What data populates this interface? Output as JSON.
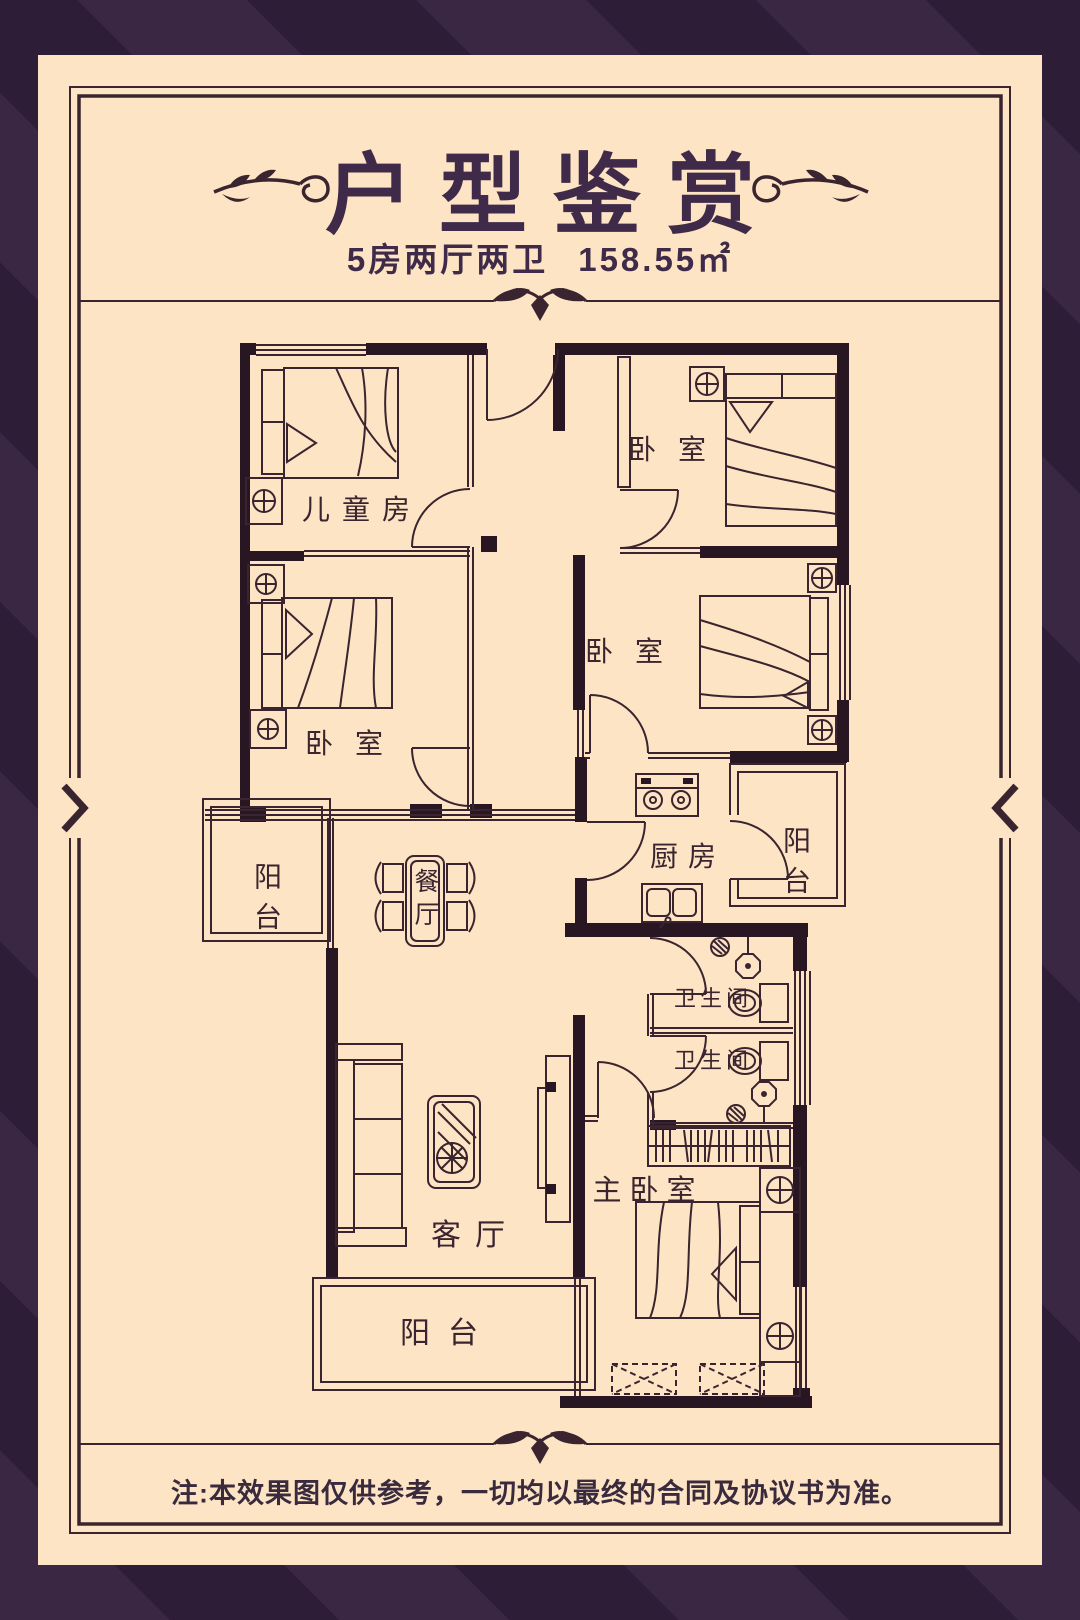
{
  "header": {
    "title": "户型鉴赏",
    "subtitle_layout": "5房两厅两卫",
    "subtitle_area": "158.55㎡"
  },
  "footer": {
    "note": "注:本效果图仅供参考，一切均以最终的合同及协议书为准。"
  },
  "colors": {
    "background_stripe_light": "#3a2744",
    "background_stripe_dark": "#2e1d37",
    "card_background": "#fde4c4",
    "ink": "#3a242f",
    "wall": "#281722",
    "title_ink": "#3f2b49"
  },
  "floorplan": {
    "rooms": [
      {
        "id": "kids-room",
        "label": "儿童房"
      },
      {
        "id": "bedroom-top-right",
        "label": "卧室"
      },
      {
        "id": "bedroom-mid-left",
        "label": "卧室"
      },
      {
        "id": "bedroom-mid-right",
        "label": "卧室"
      },
      {
        "id": "kitchen",
        "label": "厨房"
      },
      {
        "id": "balcony-right",
        "label": "阳台"
      },
      {
        "id": "balcony-left",
        "label": "阳台"
      },
      {
        "id": "dining",
        "label": "餐厅"
      },
      {
        "id": "bath-1",
        "label": "卫生间"
      },
      {
        "id": "bath-2",
        "label": "卫生间"
      },
      {
        "id": "master-bedroom",
        "label": "主卧室"
      },
      {
        "id": "living",
        "label": "客厅"
      },
      {
        "id": "balcony-bottom",
        "label": "阳台"
      }
    ]
  }
}
